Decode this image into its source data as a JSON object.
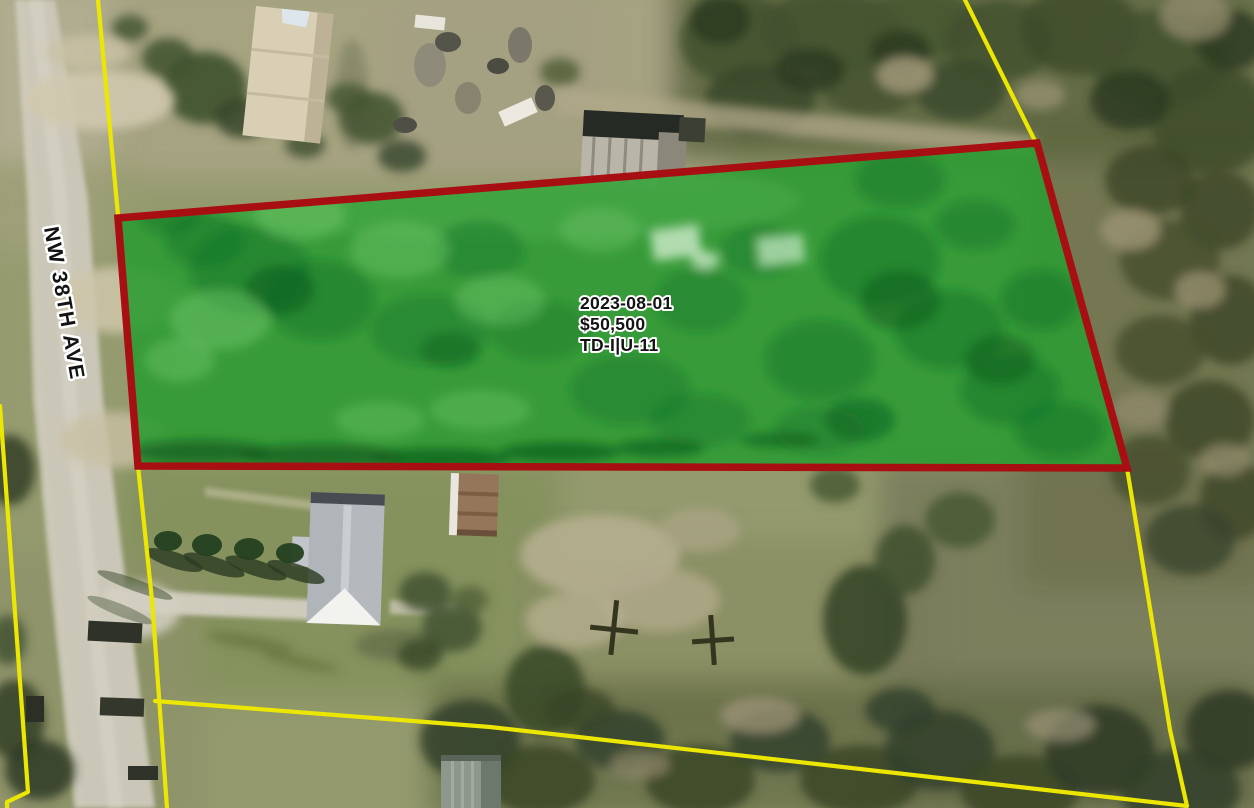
{
  "map": {
    "street_label": "NW 38TH AVE",
    "parcel_label": {
      "sale_date": "2023-08-01",
      "sale_price": "$50,500",
      "use_code": "TD-I|U-11"
    },
    "colors": {
      "parcel_fill": "#2e9b33",
      "parcel_border": "#a80f12",
      "boundary_yellow": "#ece603",
      "label_text": "#131313",
      "label_halo": "#ffffff",
      "road": "#cbc7b8",
      "grass_base": "#949a6e"
    }
  }
}
